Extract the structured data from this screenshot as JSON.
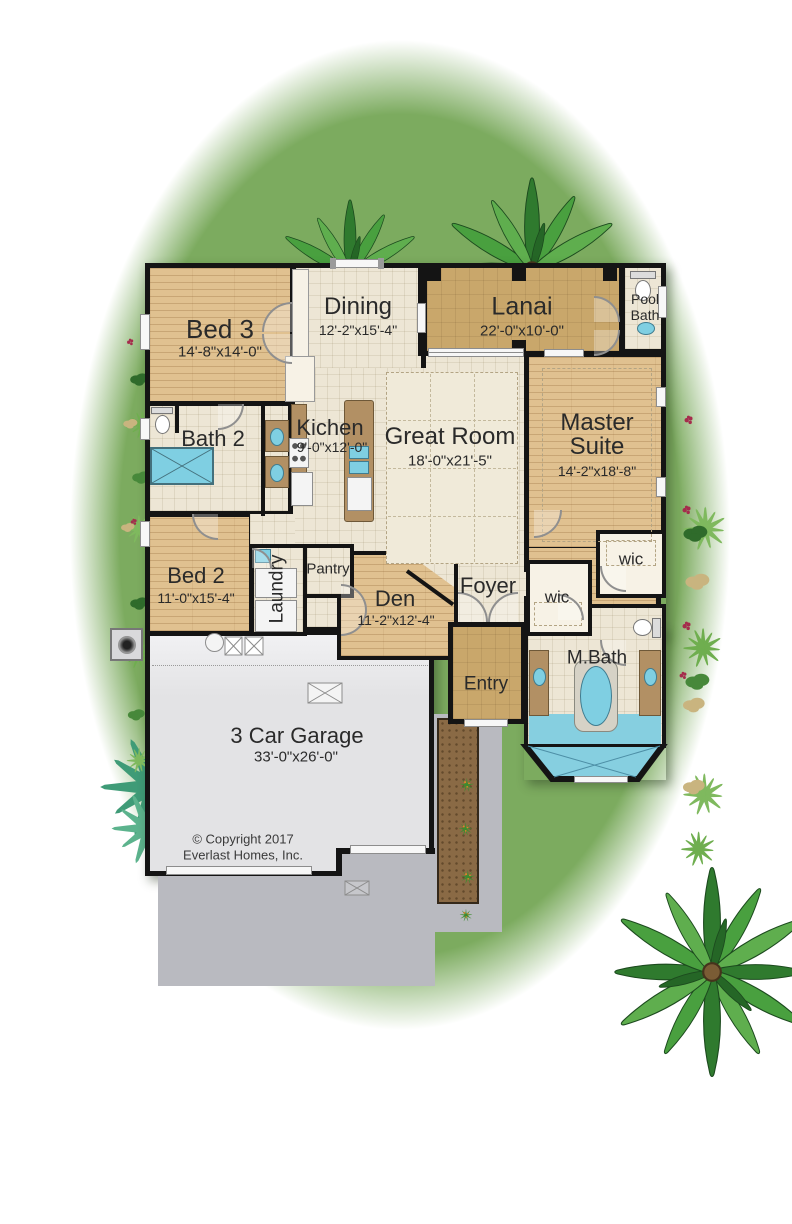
{
  "rooms": {
    "bed3": {
      "name": "Bed 3",
      "dims": "14'-8\"x14'-0\""
    },
    "dining": {
      "name": "Dining",
      "dims": "12'-2\"x15'-4\""
    },
    "lanai": {
      "name": "Lanai",
      "dims": "22'-0\"x10'-0\""
    },
    "pool_bath": {
      "line1": "Pool",
      "line2": "Bath"
    },
    "bath2": {
      "name": "Bath 2"
    },
    "kitchen": {
      "name": "Kichen",
      "dims": "9'-0\"x12'-0\""
    },
    "great_room": {
      "name": "Great Room",
      "dims": "18'-0\"x21'-5\""
    },
    "master_suite": {
      "line1": "Master",
      "line2": "Suite",
      "dims": "14'-2\"x18'-8\""
    },
    "bed2": {
      "name": "Bed 2",
      "dims": "11'-0\"x15'-4\""
    },
    "laundry": {
      "name": "Laundry"
    },
    "pantry": {
      "name": "Pantry"
    },
    "den": {
      "name": "Den",
      "dims": "11'-2\"x12'-4\""
    },
    "foyer": {
      "name": "Foyer"
    },
    "wic_left": {
      "name": "wic"
    },
    "wic_right": {
      "name": "wic"
    },
    "entry": {
      "name": "Entry"
    },
    "m_bath": {
      "name": "M.Bath"
    },
    "garage": {
      "name": "3 Car Garage",
      "dims": "33'-0\"x26'-0\""
    }
  },
  "copyright": {
    "line1": "© Copyright 2017",
    "line2": "Everlast Homes, Inc."
  },
  "colors": {
    "lawn": "#7cab5f",
    "wood_floor": "#e0c190",
    "tile_floor": "#ede6d5",
    "lanai_tan": "#c9a76b",
    "garage_gray": "#e7e7e9",
    "driveway_gray": "#b9bac0",
    "mulch_brown": "#8a6a45",
    "water_blue": "#7fcfe2",
    "wall_black": "#141414"
  }
}
